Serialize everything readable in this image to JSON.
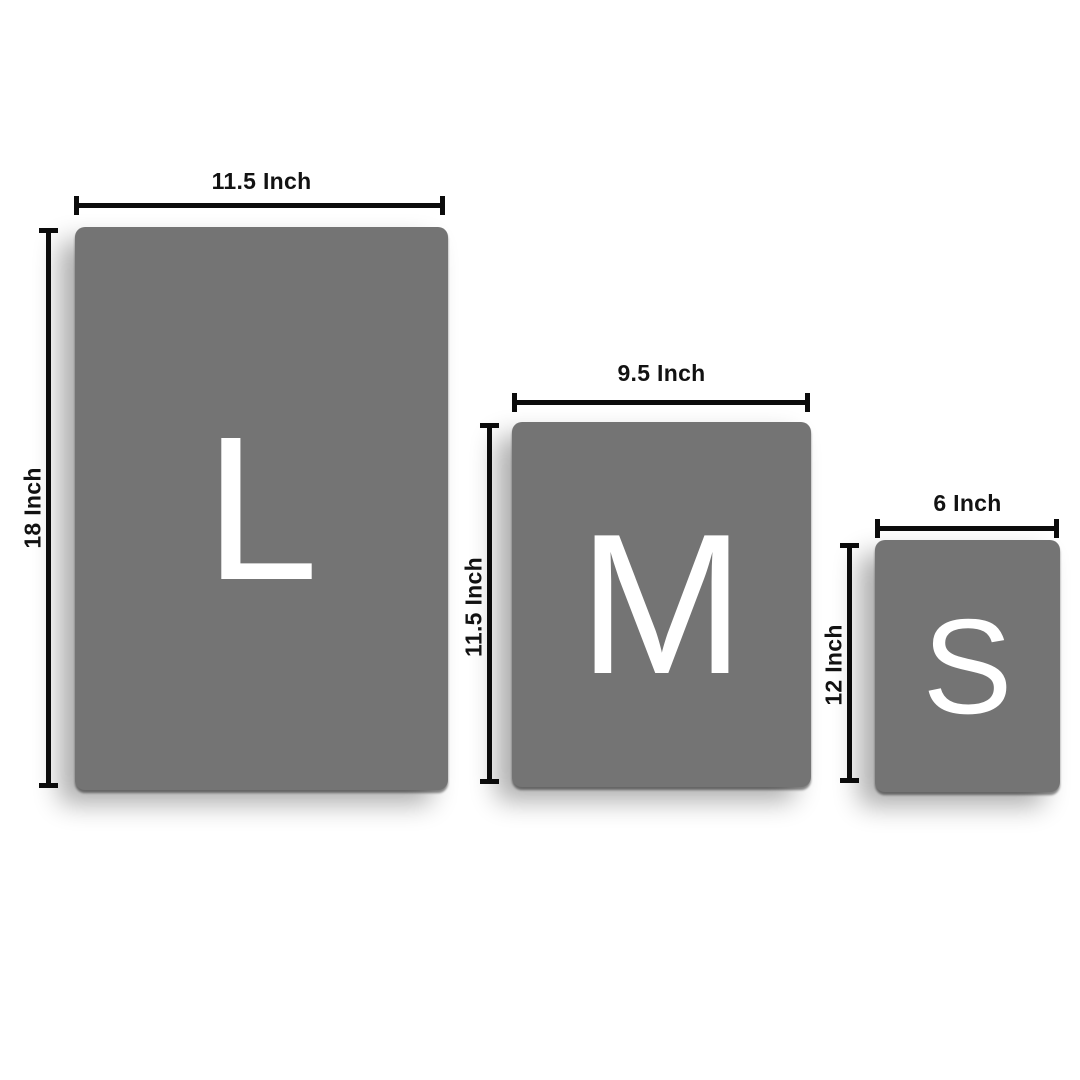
{
  "diagram": {
    "kind": "size-comparison",
    "unit": "Inch"
  },
  "colors": {
    "background": "#ffffff",
    "card_fill": "#747474",
    "dimension_line": "#0c0c0c",
    "label_text": "#121212",
    "letter_text": "#ffffff"
  },
  "cards": [
    {
      "size_name": "large",
      "letter": "L",
      "width_label": "11.5 Inch",
      "height_label": "18 Inch"
    },
    {
      "size_name": "medium",
      "letter": "M",
      "width_label": "9.5 Inch",
      "height_label": "11.5 Inch"
    },
    {
      "size_name": "small",
      "letter": "S",
      "width_label": "6 Inch",
      "height_label": "12 Inch"
    }
  ]
}
